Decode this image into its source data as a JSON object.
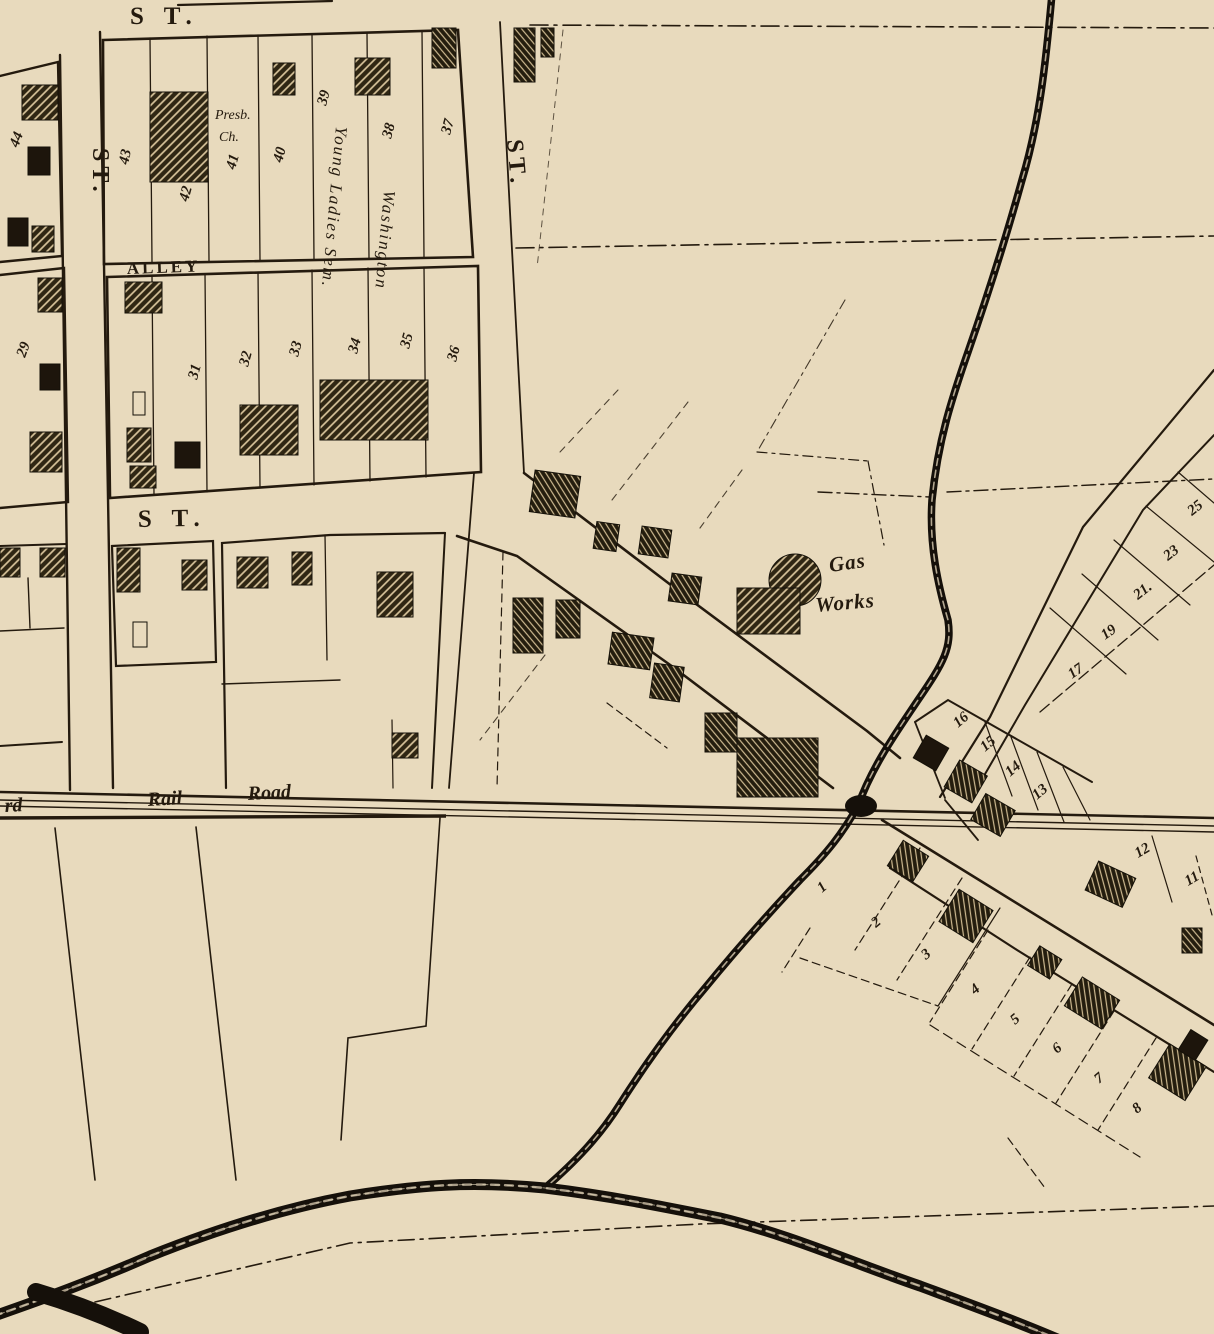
{
  "map_title": "historic town plat map sheet",
  "colors": {
    "paper": "#e8dabd",
    "ink": "#241a0e",
    "building_hatch_base": "#2f2613",
    "building_hatch_line": "#d8c49b",
    "building_solid": "#1d150c",
    "water": "#15100a"
  },
  "map": {
    "street_names": [
      "S T.",
      "S T.",
      "ST.",
      "ST.",
      "ALLEY",
      "Rail Road"
    ],
    "water_features": [
      "creek",
      "stream"
    ],
    "places": [
      "Presb. Ch.",
      "Washington Young Ladies Sem.",
      "Gas Works"
    ],
    "labels": [
      {
        "t": "S T.",
        "x": 130,
        "y": 24,
        "r": 0,
        "k": "street",
        "n": "street-label-top"
      },
      {
        "t": "S T.",
        "x": 138,
        "y": 527,
        "r": -1,
        "k": "street",
        "n": "street-label-mid"
      },
      {
        "t": "ST.",
        "x": 93,
        "y": 148,
        "r": 90,
        "k": "streetv",
        "n": "street-label-left-vertical"
      },
      {
        "t": "ST.",
        "x": 507,
        "y": 140,
        "r": 85,
        "k": "streetv",
        "n": "street-label-diagonal"
      },
      {
        "t": "ALLEY",
        "x": 127,
        "y": 274,
        "r": -2,
        "k": "alley",
        "n": "alley-label"
      },
      {
        "t": "rd",
        "x": 5,
        "y": 812,
        "r": -3,
        "k": "rail",
        "n": "railroad-label-partial"
      },
      {
        "t": "Rail",
        "x": 148,
        "y": 806,
        "r": -3,
        "k": "rail",
        "n": "railroad-label-rail"
      },
      {
        "t": "Road",
        "x": 248,
        "y": 800,
        "r": -3,
        "k": "rail",
        "n": "railroad-label-road"
      },
      {
        "t": "Gas",
        "x": 830,
        "y": 572,
        "r": -8,
        "k": "gas",
        "n": "gas-works-label"
      },
      {
        "t": "Works",
        "x": 816,
        "y": 612,
        "r": -5,
        "k": "gas",
        "n": "gas-works-label"
      },
      {
        "t": "Presb.",
        "x": 215,
        "y": 119,
        "r": 0,
        "k": "place",
        "n": "presb-church-label"
      },
      {
        "t": "Ch.",
        "x": 219,
        "y": 141,
        "r": 0,
        "k": "place",
        "n": "presb-church-label"
      },
      {
        "t": "Young Ladies Sem.",
        "x": 336,
        "y": 126,
        "r": 95,
        "k": "placev",
        "n": "seminary-label"
      },
      {
        "t": "Washington",
        "x": 384,
        "y": 190,
        "r": 95,
        "k": "placev",
        "n": "seminary-label"
      },
      {
        "t": "43",
        "x": 128,
        "y": 165,
        "r": -78,
        "k": "num",
        "n": "lot-43"
      },
      {
        "t": "42",
        "x": 188,
        "y": 202,
        "r": -75,
        "k": "num",
        "n": "lot-42"
      },
      {
        "t": "41",
        "x": 235,
        "y": 170,
        "r": -75,
        "k": "num",
        "n": "lot-41"
      },
      {
        "t": "40",
        "x": 282,
        "y": 163,
        "r": -75,
        "k": "num",
        "n": "lot-40"
      },
      {
        "t": "39",
        "x": 326,
        "y": 106,
        "r": -75,
        "k": "num",
        "n": "lot-39"
      },
      {
        "t": "38",
        "x": 391,
        "y": 139,
        "r": -75,
        "k": "num",
        "n": "lot-38"
      },
      {
        "t": "37",
        "x": 450,
        "y": 135,
        "r": -75,
        "k": "num",
        "n": "lot-37"
      },
      {
        "t": "44",
        "x": 18,
        "y": 148,
        "r": -70,
        "k": "num",
        "n": "lot-44"
      },
      {
        "t": "29",
        "x": 25,
        "y": 358,
        "r": -70,
        "k": "num",
        "n": "lot-29"
      },
      {
        "t": "31",
        "x": 197,
        "y": 380,
        "r": -75,
        "k": "num",
        "n": "lot-31"
      },
      {
        "t": "32",
        "x": 248,
        "y": 367,
        "r": -75,
        "k": "num",
        "n": "lot-32"
      },
      {
        "t": "33",
        "x": 298,
        "y": 357,
        "r": -75,
        "k": "num",
        "n": "lot-33"
      },
      {
        "t": "34",
        "x": 357,
        "y": 354,
        "r": -75,
        "k": "num",
        "n": "lot-34"
      },
      {
        "t": "35",
        "x": 409,
        "y": 349,
        "r": -75,
        "k": "num",
        "n": "lot-35"
      },
      {
        "t": "36",
        "x": 456,
        "y": 362,
        "r": -75,
        "k": "num",
        "n": "lot-36"
      },
      {
        "t": "25",
        "x": 1192,
        "y": 516,
        "r": -38,
        "k": "num",
        "n": "lot-25"
      },
      {
        "t": "23",
        "x": 1168,
        "y": 561,
        "r": -38,
        "k": "num",
        "n": "lot-23"
      },
      {
        "t": "21.",
        "x": 1138,
        "y": 600,
        "r": -38,
        "k": "num",
        "n": "lot-21"
      },
      {
        "t": "19",
        "x": 1105,
        "y": 640,
        "r": -35,
        "k": "num",
        "n": "lot-19"
      },
      {
        "t": "17",
        "x": 1072,
        "y": 679,
        "r": -35,
        "k": "num",
        "n": "lot-17"
      },
      {
        "t": "16",
        "x": 958,
        "y": 728,
        "r": -40,
        "k": "num",
        "n": "lot-16"
      },
      {
        "t": "15",
        "x": 985,
        "y": 752,
        "r": -40,
        "k": "num",
        "n": "lot-15"
      },
      {
        "t": "14",
        "x": 1010,
        "y": 777,
        "r": -40,
        "k": "num",
        "n": "lot-14"
      },
      {
        "t": "13",
        "x": 1037,
        "y": 800,
        "r": -40,
        "k": "num",
        "n": "lot-13"
      },
      {
        "t": "12",
        "x": 1138,
        "y": 858,
        "r": -30,
        "k": "num",
        "n": "lot-12"
      },
      {
        "t": "11",
        "x": 1188,
        "y": 886,
        "r": -30,
        "k": "num",
        "n": "lot-11"
      },
      {
        "t": "1",
        "x": 822,
        "y": 893,
        "r": -40,
        "k": "num",
        "n": "lot-1"
      },
      {
        "t": "2",
        "x": 876,
        "y": 928,
        "r": -40,
        "k": "num",
        "n": "lot-2"
      },
      {
        "t": "3",
        "x": 926,
        "y": 960,
        "r": -40,
        "k": "num",
        "n": "lot-3"
      },
      {
        "t": "4",
        "x": 975,
        "y": 995,
        "r": -40,
        "k": "num",
        "n": "lot-4"
      },
      {
        "t": "5",
        "x": 1015,
        "y": 1025,
        "r": -40,
        "k": "num",
        "n": "lot-5"
      },
      {
        "t": "6",
        "x": 1057,
        "y": 1054,
        "r": -40,
        "k": "num",
        "n": "lot-6"
      },
      {
        "t": "7",
        "x": 1099,
        "y": 1084,
        "r": -40,
        "k": "num",
        "n": "lot-7"
      },
      {
        "t": "8",
        "x": 1137,
        "y": 1114,
        "r": -40,
        "k": "num",
        "n": "lot-8"
      }
    ]
  }
}
